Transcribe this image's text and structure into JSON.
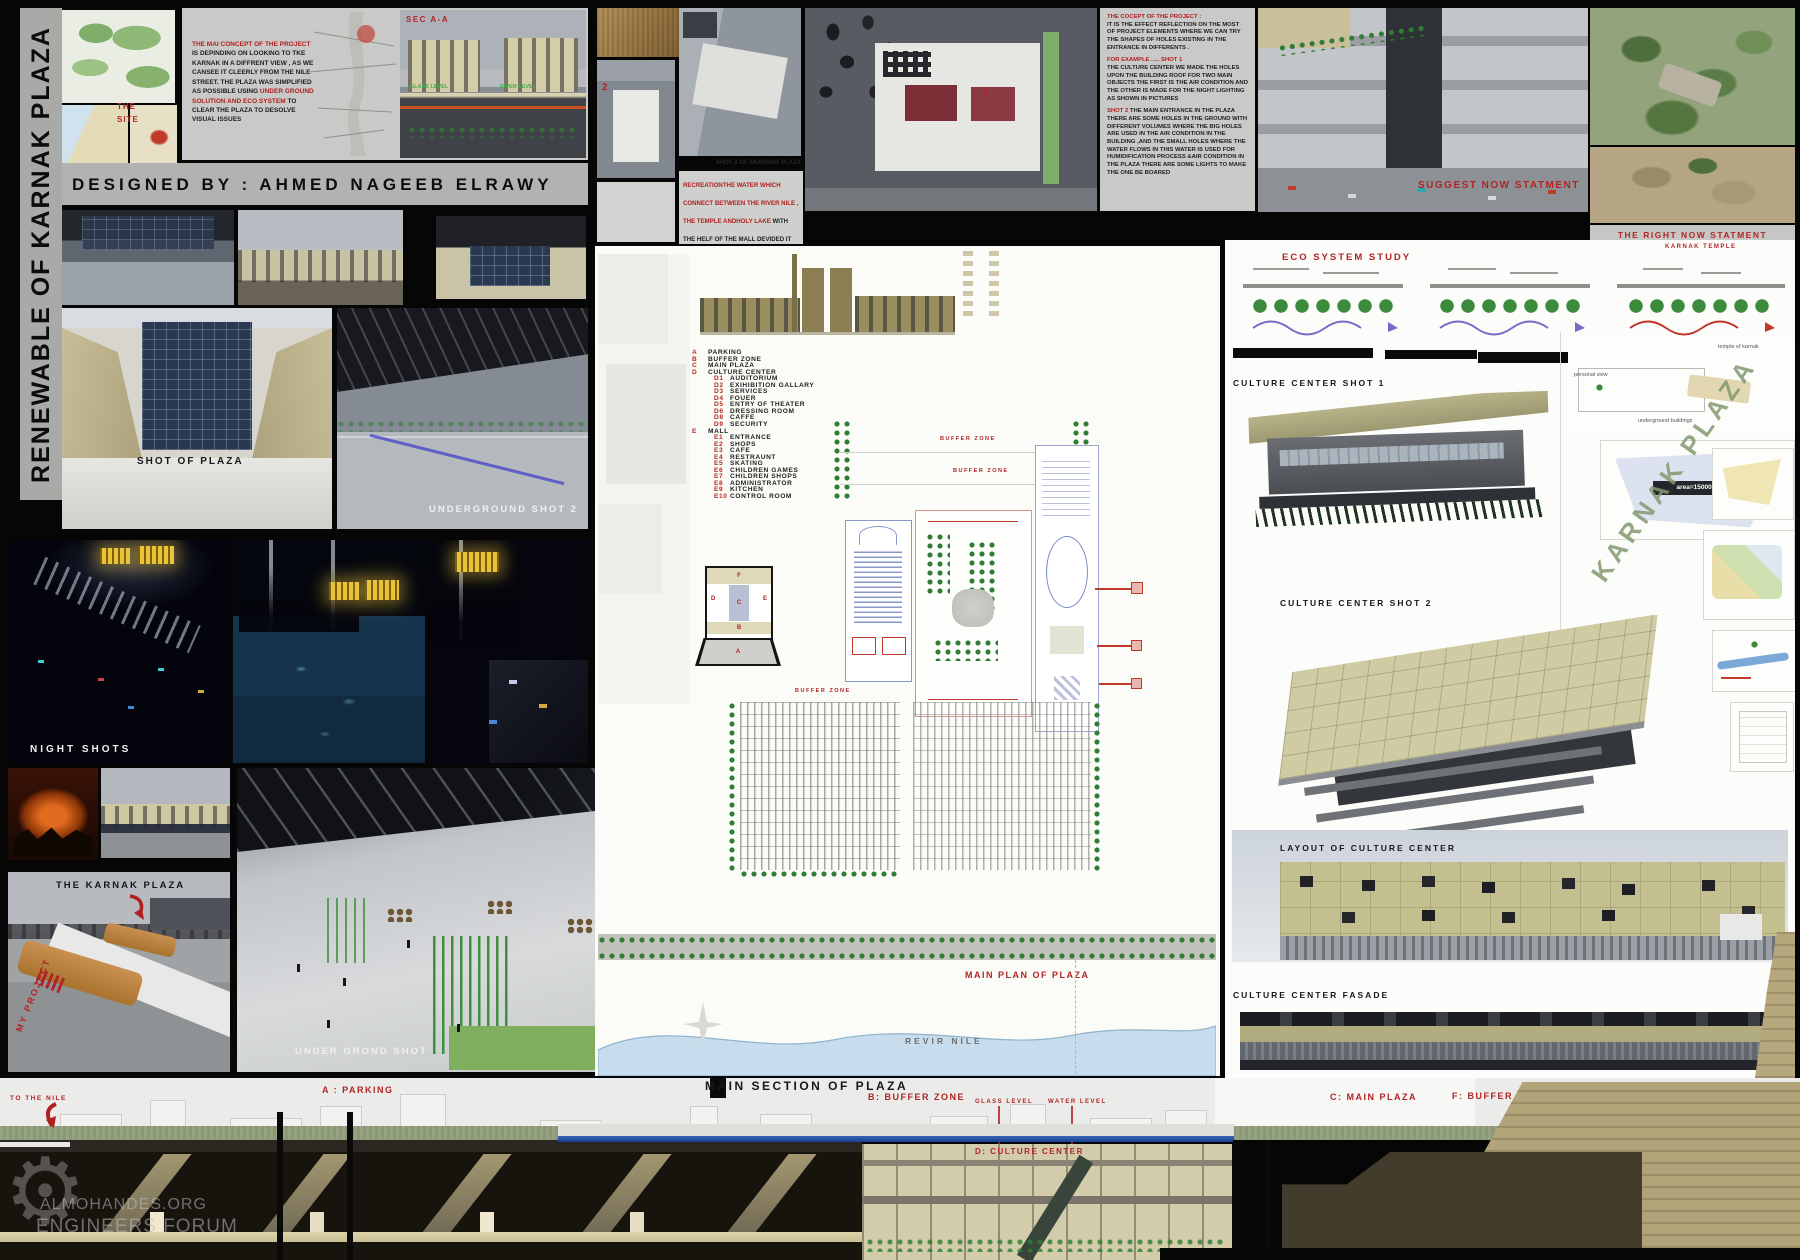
{
  "colors": {
    "accent_red": "#b02525",
    "panel_gray": "#c9c9c7",
    "olive": "#c3bf8e",
    "night_yellow": "#e7c43a",
    "river_blue": "#c7dcec"
  },
  "board": {
    "vertical_title": "RENEWABLE OF KARNAK PLAZA",
    "designed_by": "DESIGNED BY : AHMED NAGEEB ELRAWY",
    "watermark_line1": "ALMOHANDES.ORG",
    "watermark_line2": "ENGINEERS FORUM"
  },
  "top_left": {
    "the": "THE",
    "site": "SITE",
    "sec_label": "SEC A-A",
    "glass_level": "GLASS LEVEL",
    "river_level": "RIVER LEVEL",
    "concept": {
      "red1": "THE MAI CONCEPT OF THE PROJECT ",
      "black1": "IS DEPINDING ON LOOKING TO TKE KARNAK IN A DIFFRENT VIEW , AS WE CANSEE IT CLEERLY FROM THE NILE STREET. THE PLAZA WAS SIMPLIFIED AS POSSIBLE USING ",
      "red2": "UNDER GROUND SOLUTION AND ECO SYSTEM ",
      "black2": "TO CLEAR THE PLAZA TO DESOLVE VISUAL ISSUES"
    }
  },
  "concept_block": {
    "title": "THE COCEPT OF THE PROJECT :",
    "p1": "IT IS THE EFFECT REFLECTION ON THE MOST OF PROJECT ELEMENTS WHERE WE CAN TRY THE SHAPES OF HOLES EXISTING IN THE ENTRANCE IN DIFFERENTS .",
    "example": "FOR EXAMPLE ..... SHOT 1",
    "p2": "THE CULTURE CENTER WE MADE THE HOLES UPON THE BUILDING ROOF FOR TWO MAIN OBJECTS THE FIRST IS THE AIR CONDITION AND THE OTHER IS MADE FOR THE NIGHT LIGHTING AS SHOWN IN PICTURES",
    "shot2": "SHOT 2",
    "p3": " THE MAIN ENTRANCE IN THE PLAZA THERE ARE SOME HOLES IN THE GROUND WITH DIFFERENT VOLUMES WHERE THE BIG HOLES ARE USED IN THE AIR CONDITION IN THE BUILDING ,AND THE SMALL HOLES WHERE THE WATER FLOWS IN THIS WATER IS USED FOR HUMIDIFICATION PROCESS &AIR CONDITION IN THE PLAZA THERE ARE SOME LIGHTS TO MAKE THE ONE BE BOARED"
  },
  "recreation": {
    "caption": "SHOT 2 OF AKARNAK PLAZA",
    "red": "RECREATIONTHE WATER WHICH CONNECT BETWEEN THE RIVER NILE , THE TEMPLE ANDHOLY LAKE ",
    "black": "WITH THE HELF OF THE MALL DEVIDED IT INTO THREE ZONES WHICH LOOKS LIKE THE HOLES WHICH USED IN THE TEMPLE FACADE"
  },
  "captions": {
    "shot_of_plaza": "SHOT OF PLAZA",
    "underground_shot_2": "UNDERGROUND SHOT 2",
    "night_shots": "NIGHT SHOTS",
    "the_karnak_plaza": "THE KARNAK PLAZA",
    "my_project": "MY PROJECT",
    "under_grond_shot": "UNDER GROND SHOT",
    "suggest_now": "SUGGEST NOW STATMENT",
    "right_now": "THE RIGHT NOW STATMENT",
    "marker1": "1",
    "marker2": "2"
  },
  "legend": {
    "items": [
      {
        "key": "A",
        "label": "PARKING"
      },
      {
        "key": "B",
        "label": "BUFFER ZONE"
      },
      {
        "key": "C",
        "label": "MAIN PLAZA"
      },
      {
        "key": "D",
        "label": "CULTURE CENTER"
      },
      {
        "key": "D1",
        "label": "AUDITORIUM"
      },
      {
        "key": "D2",
        "label": "EXIHIBITION GALLARY"
      },
      {
        "key": "D3",
        "label": "SERVICES"
      },
      {
        "key": "D4",
        "label": "FOUER"
      },
      {
        "key": "D5",
        "label": "ENTRY OF THEATER"
      },
      {
        "key": "D6",
        "label": "DRESSING ROOM"
      },
      {
        "key": "D8",
        "label": "CAFFE"
      },
      {
        "key": "D9",
        "label": "SECURITY"
      },
      {
        "key": "E",
        "label": "MALL"
      },
      {
        "key": "E1",
        "label": "ENTRANCE"
      },
      {
        "key": "E2",
        "label": "SHOPS"
      },
      {
        "key": "E3",
        "label": "CAFE"
      },
      {
        "key": "E4",
        "label": "RESTRAUNT"
      },
      {
        "key": "E5",
        "label": "SKATING"
      },
      {
        "key": "E6",
        "label": "CHILDREN GAMES"
      },
      {
        "key": "E7",
        "label": "CHILDREN SHOPS"
      },
      {
        "key": "E8",
        "label": "ADMINISTRATOR"
      },
      {
        "key": "E9",
        "label": "KITCHEN"
      },
      {
        "key": "E10",
        "label": "CONTROL ROOM"
      }
    ]
  },
  "key_diagram": {
    "f": "F",
    "d": "D",
    "c": "C",
    "e": "E",
    "b": "B",
    "a": "A"
  },
  "plan": {
    "buffer_zone": "BUFFER ZONE",
    "main_plan": "MAIN PLAN OF PLAZA",
    "river": "REVIR NILE"
  },
  "right_col": {
    "eco_title": "ECO SYSTEM STUDY",
    "karnak_temple_small": "KARNAK TEMPLE",
    "shot1_caption": "CULTURE CENTER SHOT 1",
    "shot2_caption": "CULTURE CENTER SHOT 2",
    "karnak_plaza_diag": "KARNAK PLAZA",
    "layout_caption": "LAYOUT OF CULTURE CENTER",
    "fasade_caption": "CULTURE CENTER FASADE",
    "temple_of_karnak": "temple of karnak",
    "underground_buildings": "underground buildings",
    "personal_view": "personal view",
    "area_label": "area=15000 m²"
  },
  "bottom": {
    "main_section": "MAIN SECTION OF PLAZA",
    "to_the_nile": "TO THE NILE",
    "a_parking": "A :  PARKING",
    "b_buffer": "B: BUFFER ZONE",
    "c_main_plaza": "C: MAIN PLAZA",
    "glass_level": "GLASS LEVEL",
    "water_level": "WATER LEVEL",
    "d_culture": "D: CULTURE CENTER",
    "f_buffer": "F: BUFFER ZONE",
    "karnak_temple": "KARNAK TEMPLE"
  }
}
